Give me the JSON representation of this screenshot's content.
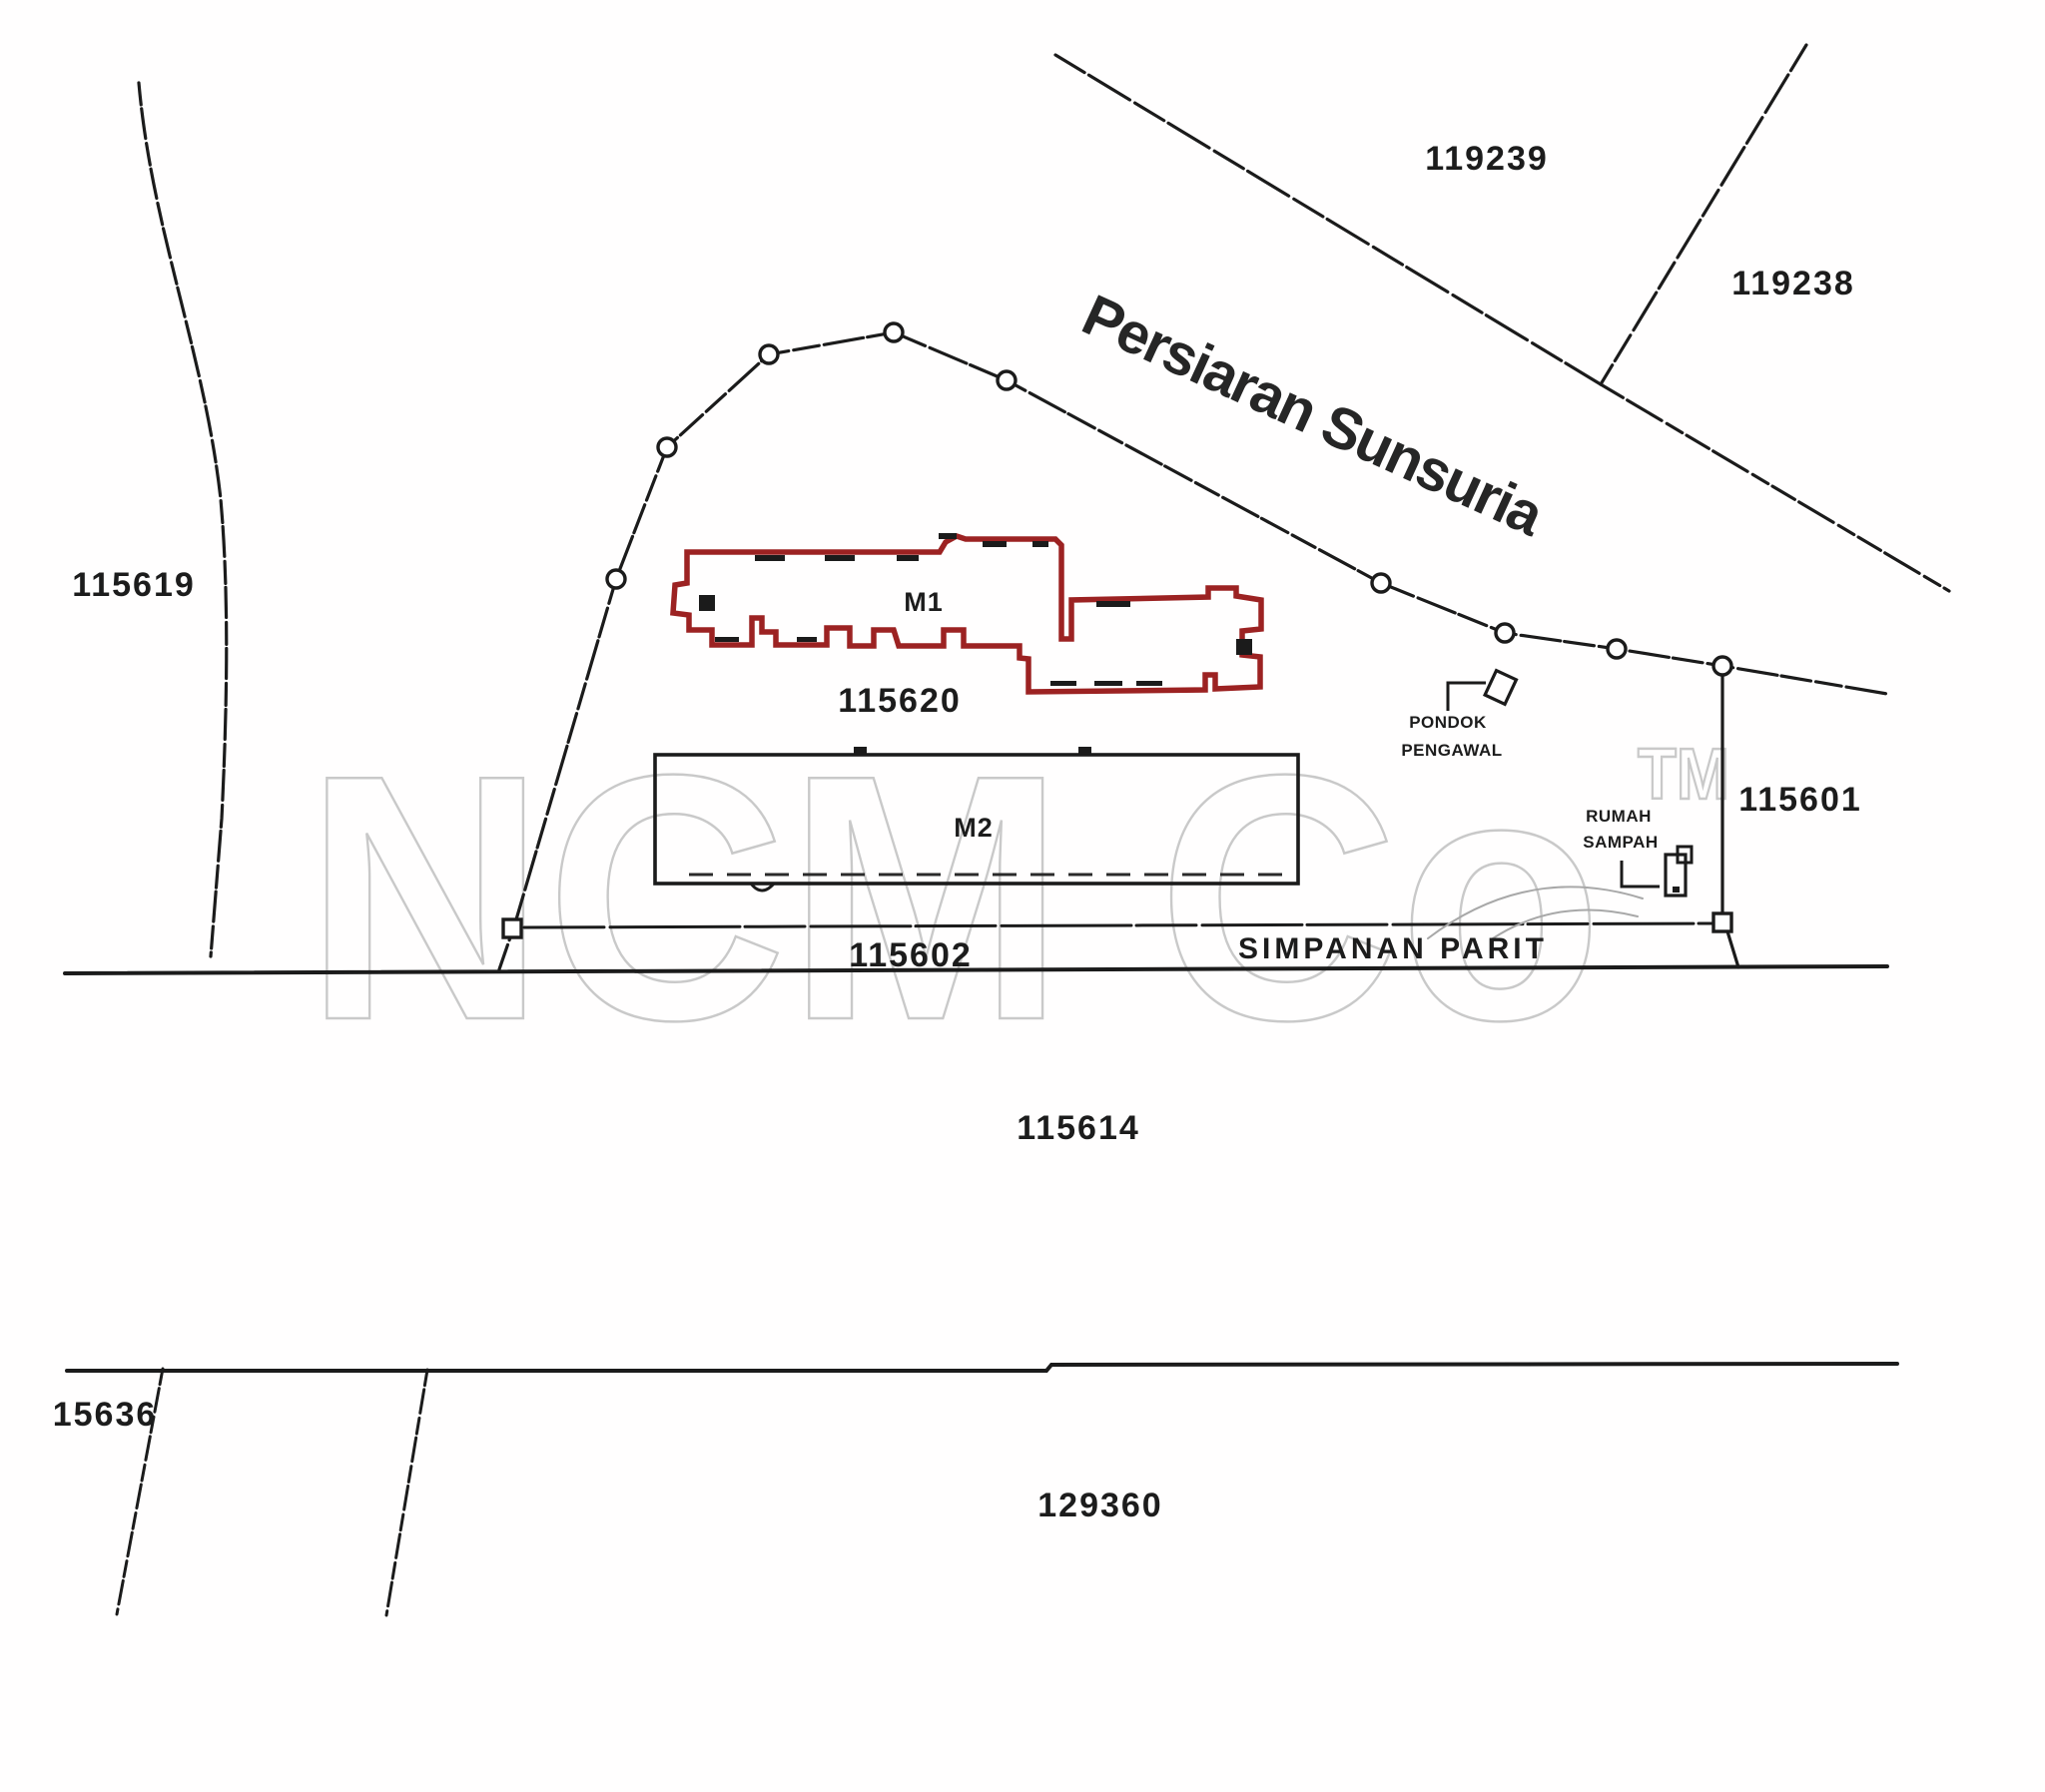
{
  "watermark": {
    "brand": "NCM Co",
    "tm": "TM"
  },
  "road": {
    "name": "Persiaran Sunsuria"
  },
  "lots": {
    "l119239": "119239",
    "l119238": "119238",
    "l115619": "115619",
    "l115620": "115620",
    "l115601": "115601",
    "l115602": "115602",
    "l115614": "115614",
    "l15636": "15636",
    "l129360": "129360"
  },
  "buildings": {
    "m1": "M1",
    "m2": "M2"
  },
  "labels": {
    "simpanan_parit": "SIMPANAN PARIT",
    "pondok_line1": "PONDOK",
    "pondok_line2": "PENGAWAL",
    "rumah_line1": "RUMAH",
    "rumah_line2": "SAMPAH"
  },
  "colors": {
    "building_outline": "#9c2222",
    "line_ink": "#1b1b1b",
    "watermark": "#c9c9c9"
  }
}
